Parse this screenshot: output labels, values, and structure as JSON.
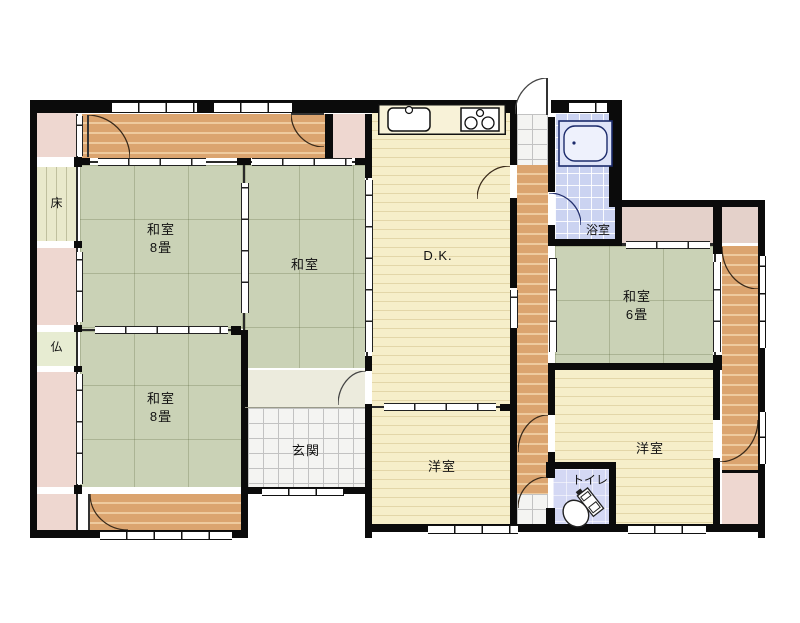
{
  "plan_type": "floorplan",
  "rooms": {
    "washitsu8_nw": {
      "name": "和室",
      "size": "8畳"
    },
    "washitsu_mid": {
      "name": "和室"
    },
    "washitsu8_sw": {
      "name": "和室",
      "size": "8畳"
    },
    "washitsu6_e": {
      "name": "和室",
      "size": "6畳"
    },
    "dk": {
      "name": "D.K."
    },
    "bath": {
      "name": "浴室"
    },
    "toilet": {
      "name": "トイレ"
    },
    "genkan": {
      "name": "玄関"
    },
    "yoshitsu_s": {
      "name": "洋室"
    },
    "yoshitsu_se": {
      "name": "洋室"
    },
    "tokonoma": {
      "name": "床"
    },
    "butsuma": {
      "name": "仏"
    }
  },
  "icons": [
    "kitchen-sink-icon",
    "kitchen-stove-icon",
    "bathtub-icon",
    "toilet-icon",
    "door-arc"
  ],
  "colors": {
    "wall": "#0b0b0b",
    "tatami": "#cad2b6",
    "wood_floor": "#dba46f",
    "cream_floor": "#f6eec9",
    "closet_pink": "#eed7d0",
    "bath_tile": "#cbd3f1",
    "toilet_floor": "#d4d8f4",
    "entry_tile": "#f4f4f2",
    "tokonoma": "#e9e9cb",
    "background": "#ffffff"
  }
}
